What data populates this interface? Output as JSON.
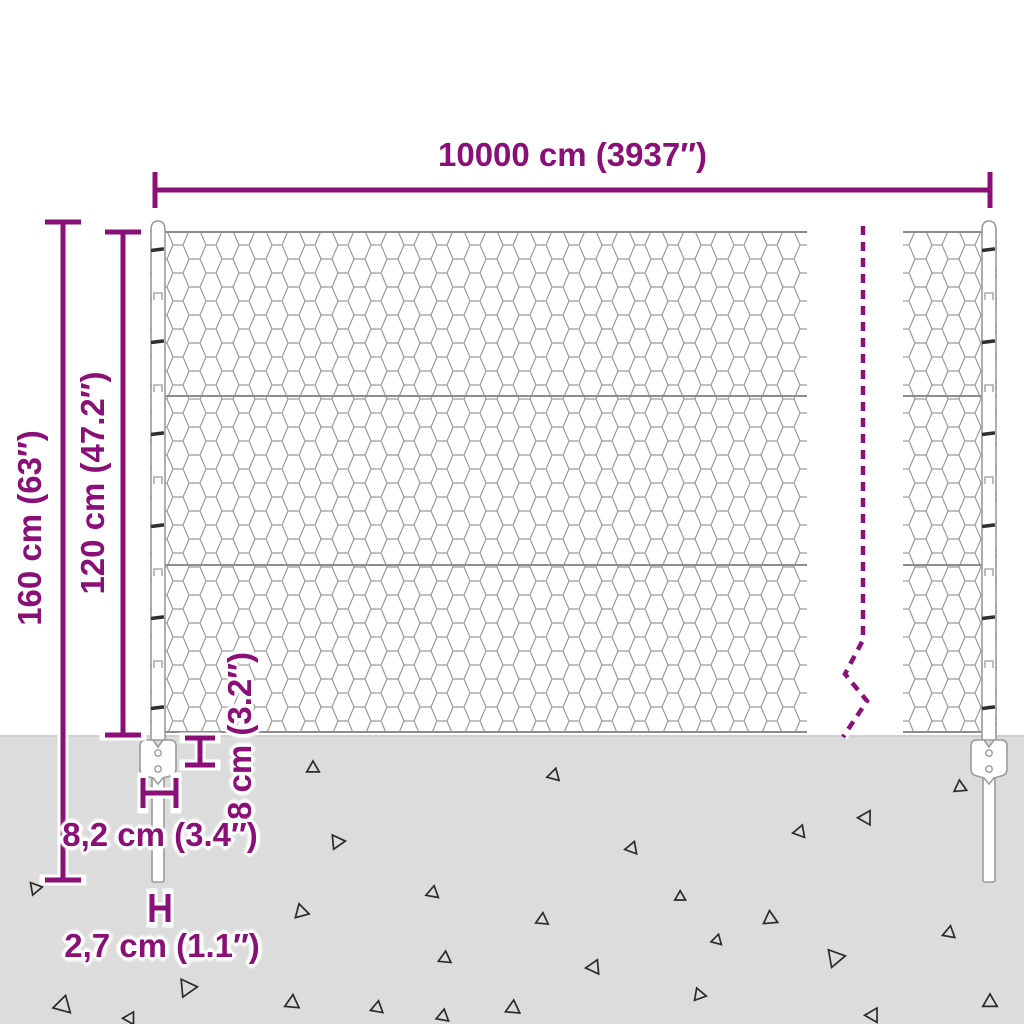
{
  "diagram": {
    "type": "fence-product-dimension-diagram",
    "description": "Wire mesh fence with posts, anchor plates and ground spikes, annotated with dimensions"
  },
  "dimensions": {
    "width": {
      "label": "10000 cm (3937″)"
    },
    "total_height": {
      "label": "160 cm (63″)"
    },
    "mesh_height": {
      "label": "120 cm (47.2″)"
    },
    "anchor_depth": {
      "label": "8 cm (3.2″)"
    },
    "anchor_width": {
      "label": "8,2 cm (3.4″)"
    },
    "spike_width": {
      "label": "2,7 cm (1.1″)"
    }
  },
  "colors": {
    "accent": "#8a1078",
    "ground": "#dcdcdc",
    "mesh_wire": "#9a9a9a",
    "outline": "#9b9b9b",
    "triangle": "#2b2b2b",
    "background": "#ffffff"
  },
  "ground": {
    "triangles": [
      {
        "x": 313,
        "y": 768,
        "s": 7,
        "r": 0
      },
      {
        "x": 554,
        "y": 775,
        "s": 7,
        "r": 15
      },
      {
        "x": 960,
        "y": 787,
        "s": 7,
        "r": 355
      },
      {
        "x": 866,
        "y": 818,
        "s": 8,
        "r": 150
      },
      {
        "x": 800,
        "y": 832,
        "s": 7,
        "r": 140
      },
      {
        "x": 337,
        "y": 842,
        "s": 8,
        "r": 205
      },
      {
        "x": 632,
        "y": 848,
        "s": 7,
        "r": 20
      },
      {
        "x": 433,
        "y": 893,
        "s": 7,
        "r": 130
      },
      {
        "x": 301,
        "y": 912,
        "s": 8,
        "r": 225
      },
      {
        "x": 542,
        "y": 920,
        "s": 7,
        "r": 245
      },
      {
        "x": 770,
        "y": 919,
        "s": 8,
        "r": 235
      },
      {
        "x": 717,
        "y": 940,
        "s": 6,
        "r": 15
      },
      {
        "x": 949,
        "y": 933,
        "s": 7,
        "r": 250
      },
      {
        "x": 680,
        "y": 897,
        "s": 6,
        "r": 240
      },
      {
        "x": 445,
        "y": 958,
        "s": 7,
        "r": 5
      },
      {
        "x": 835,
        "y": 958,
        "s": 10,
        "r": 200
      },
      {
        "x": 594,
        "y": 967,
        "s": 8,
        "r": 25
      },
      {
        "x": 187,
        "y": 988,
        "s": 10,
        "r": 205
      },
      {
        "x": 63,
        "y": 1005,
        "s": 10,
        "r": 15
      },
      {
        "x": 292,
        "y": 1003,
        "s": 8,
        "r": 245
      },
      {
        "x": 377,
        "y": 1008,
        "s": 7,
        "r": 250
      },
      {
        "x": 513,
        "y": 1008,
        "s": 8,
        "r": 5
      },
      {
        "x": 699,
        "y": 995,
        "s": 7,
        "r": 220
      },
      {
        "x": 990,
        "y": 1002,
        "s": 8,
        "r": 0
      },
      {
        "x": 130,
        "y": 1018,
        "s": 7,
        "r": 30
      },
      {
        "x": 443,
        "y": 1016,
        "s": 7,
        "r": 10
      },
      {
        "x": 873,
        "y": 1015,
        "s": 8,
        "r": 30
      },
      {
        "x": 35,
        "y": 888,
        "s": 7,
        "r": 320
      }
    ]
  }
}
